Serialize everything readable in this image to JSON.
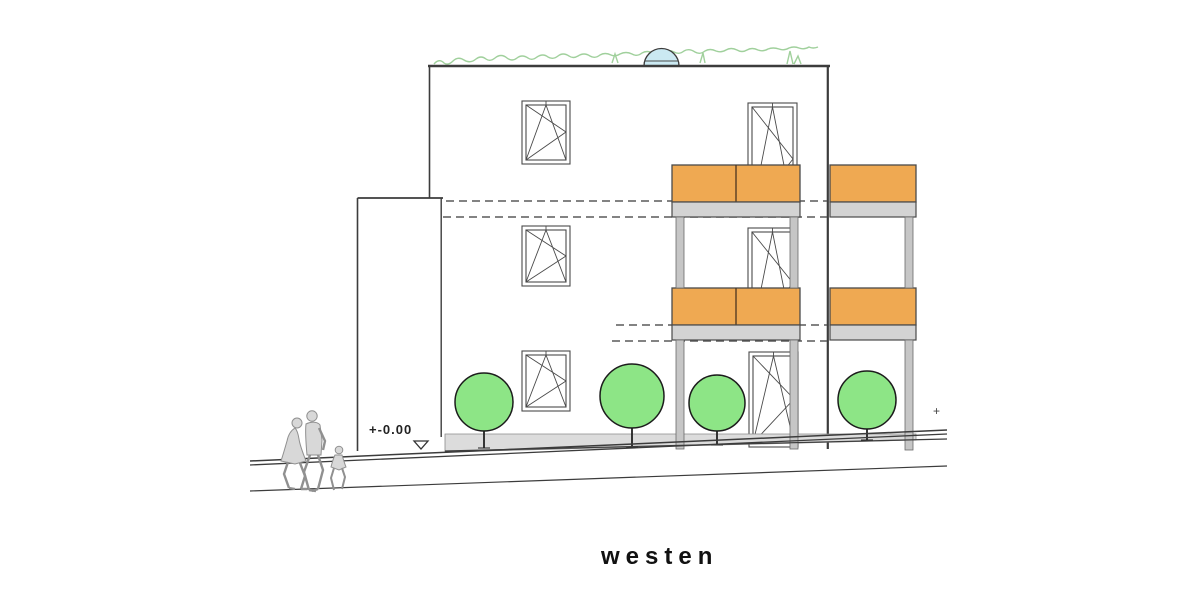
{
  "labels": {
    "orientation": "westen",
    "datum": "+-0.00",
    "elevation_mark": "+"
  },
  "colors": {
    "line": "#3c3c3c",
    "balcony_orange": "#efa952",
    "slab_gray": "#d3d3d3",
    "post_gray": "#c6c6c6",
    "tree_green": "#8de586",
    "glass_cyan": "#c9edf3",
    "grass_green": "#a0d09c",
    "dome_blue": "#cbe9f2",
    "plinth_gray": "#dcdcdc",
    "people_gray": "#d8d8d8"
  },
  "scene": {
    "view_label": "westen",
    "floors": 3,
    "left_column_windows": 3,
    "balcony_doors": 3,
    "balcony_railings": 4,
    "trees": 4,
    "people": [
      "woman",
      "man",
      "child"
    ],
    "roof_features": [
      "green-roof-grass",
      "dome-skylight"
    ],
    "ground_datum": "+-0.00"
  }
}
